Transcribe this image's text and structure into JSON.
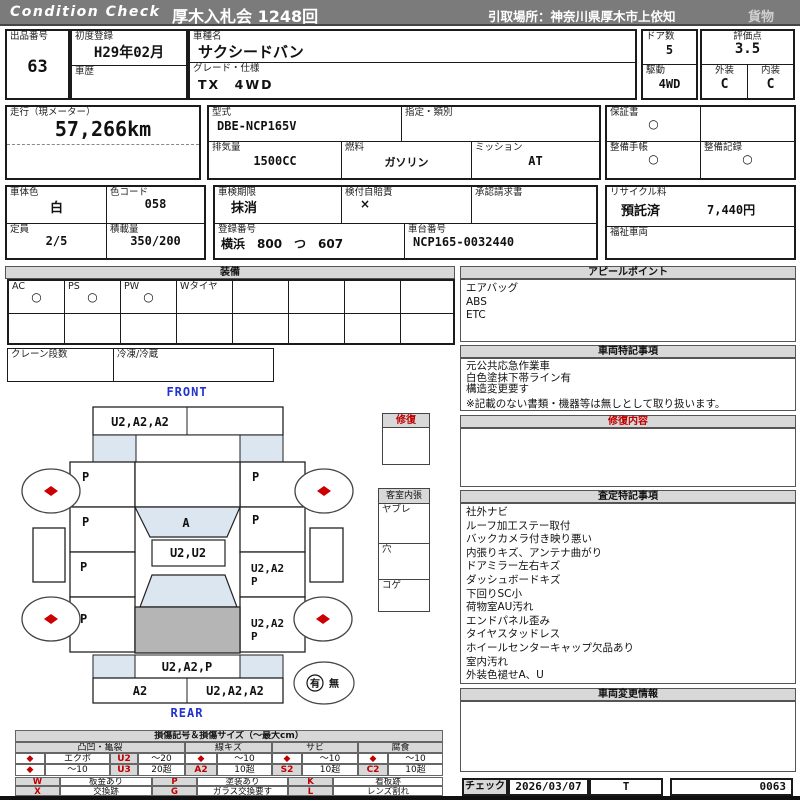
{
  "header": {
    "brand": "Condition Check",
    "auction": "厚木入札会 1248回",
    "pickup": "引取場所：神奈川県厚木市上依知",
    "category": "貨物"
  },
  "vehicle": {
    "lot_label": "出品番号",
    "lot_no": "63",
    "first_reg_label": "初度登録",
    "first_reg": "H29年02月",
    "history_label": "車歴",
    "history": "",
    "model_name_label": "車種名",
    "model_name": "サクシードバン",
    "grade_label": "グレード・仕様",
    "grade": "TX　4WD",
    "doors_label": "ドア数",
    "doors": "5",
    "drive_label": "駆動",
    "drive": "4WD",
    "score_label": "評価点",
    "score": "3.5",
    "exterior_label": "外装",
    "exterior": "C",
    "interior_label": "内装",
    "interior": "C",
    "mileage_label": "走行（現メーター）",
    "mileage": "57,266km",
    "model_code_label": "型式",
    "model_code": "DBE-NCP165V",
    "class_label": "指定・類別",
    "class_value": "",
    "displacement_label": "排気量",
    "displacement": "1500CC",
    "fuel_label": "燃料",
    "fuel": "ガソリン",
    "mission_label": "ミッション",
    "mission": "AT",
    "warranty_label": "保証書",
    "warranty": "○",
    "maint_book_label": "整備手帳",
    "maint_book": "○",
    "maint_record_label": "整備記録",
    "maint_record": "○",
    "body_color_label": "車体色",
    "body_color": "白",
    "color_code_label": "色コード",
    "color_code": "058",
    "capacity_label": "定員",
    "capacity": "2/5",
    "load_label": "積載量",
    "load": "350/200",
    "inspection_label": "車検期限",
    "inspection": "抹消",
    "insurance_label": "検付自賠責",
    "insurance": "×",
    "approval_label": "承認請求書",
    "approval": "",
    "reg_no_label": "登録番号",
    "reg_no": "横浜　800　つ　607",
    "chassis_label": "車台番号",
    "chassis": "NCP165-0032440",
    "recycle_label": "リサイクル料",
    "recycle_status": "預託済",
    "recycle_fee": "7,440円",
    "welfare_label": "福祉車両",
    "welfare": ""
  },
  "equipment": {
    "title": "装備",
    "labels": [
      "AC",
      "PS",
      "PW",
      "Wタイヤ",
      "",
      "",
      "",
      ""
    ],
    "values": [
      "○",
      "○",
      "○",
      "",
      "",
      "",
      "",
      ""
    ],
    "crane_label": "クレーン段数",
    "crane_value": "",
    "reefer_label": "冷凍/冷蔵",
    "reefer_value": ""
  },
  "appeal": {
    "title": "アピールポイント",
    "lines": [
      "エアバッグ",
      "ABS",
      "ETC"
    ]
  },
  "special_notes": {
    "title": "車両特記事項",
    "lines": [
      "元公共応急作業車",
      "白色塗抹下帯ライン有",
      "構造変更要す"
    ],
    "footnote": "※記載のない書類・機器等は無しとして取り扱います。"
  },
  "repair_content": {
    "title": "修復内容",
    "content": ""
  },
  "assessment": {
    "title": "査定特記事項",
    "lines": [
      "社外ナビ",
      "ルーフ加工ステー取付",
      "バックカメラ付き映り悪い",
      "内張りキズ、アンテナ曲がり",
      "ドアミラー左右キズ",
      "ダッシュボードキズ",
      "下回りSC小",
      "荷物室AU汚れ",
      "エンドパネル歪み",
      "タイヤスタッドレス",
      "ホイールセンターキャップ欠品あり",
      "室内汚れ",
      "外装色褪せA、U"
    ]
  },
  "change_info": {
    "title": "車両変更情報",
    "content": ""
  },
  "check": {
    "label": "チェック",
    "date": "2026/03/07",
    "inspector": "T",
    "number": "0063"
  },
  "diagram": {
    "front_label": "FRONT",
    "rear_label": "REAR",
    "repair_box_title": "修復",
    "interior": {
      "title": "客室内張",
      "items": [
        "ヤブレ",
        "穴",
        "コゲ"
      ]
    },
    "codes": {
      "front_bumper_left": "U2,A2,A2",
      "windshield": "A",
      "roof_front": "U2,U2",
      "left_fender": "P",
      "left_front_door": "P",
      "left_rear_door": "P",
      "left_quarter": "P",
      "right_fender": "P",
      "right_front_door": "P",
      "right_rear_door_1": "U2,A2",
      "right_rear_door_2": "P",
      "right_quarter_1": "U2,A2",
      "right_quarter_2": "P",
      "rear_bumper": "U2,A2,P",
      "rear_panel_left": "A2",
      "rear_panel_right": "U2,A2,A2"
    },
    "presence": {
      "yes": "有",
      "no": "無"
    }
  },
  "legend": {
    "title": "損傷記号＆損傷サイズ（〜最大cm）",
    "diamond": "◆",
    "groups": [
      {
        "name": "凸凹・亀裂",
        "r1": {
          "label": "エクボ",
          "code": "U2",
          "size": "〜20"
        },
        "r2": {
          "label": "〜10",
          "code": "U3",
          "size": "20超"
        }
      },
      {
        "name": "線キズ",
        "r1": {
          "size": "〜10"
        },
        "r2": {
          "code": "A2",
          "size": "10超"
        }
      },
      {
        "name": "サビ",
        "r1": {
          "size": "〜10"
        },
        "r2": {
          "code": "S2",
          "size": "10超"
        }
      },
      {
        "name": "腐食",
        "r1": {
          "size": "〜10"
        },
        "r2": {
          "code": "C2",
          "size": "10超"
        }
      }
    ],
    "marks": [
      {
        "code": "W",
        "desc": "板金あり"
      },
      {
        "code": "P",
        "desc": "塗装あり"
      },
      {
        "code": "K",
        "desc": "看板跡"
      },
      {
        "code": "X",
        "desc": "交換跡"
      },
      {
        "code": "G",
        "desc": "ガラス交換要す"
      },
      {
        "code": "L",
        "desc": "レンズ割れ"
      }
    ]
  },
  "colors": {
    "header_bar": "#7b7b7b",
    "section_header": "#d8d8d8",
    "glass_blue": "#dce6f1",
    "roof_gray": "#b5b5b5",
    "damage_red": "#cc0000",
    "direction_blue": "#2233cc"
  }
}
